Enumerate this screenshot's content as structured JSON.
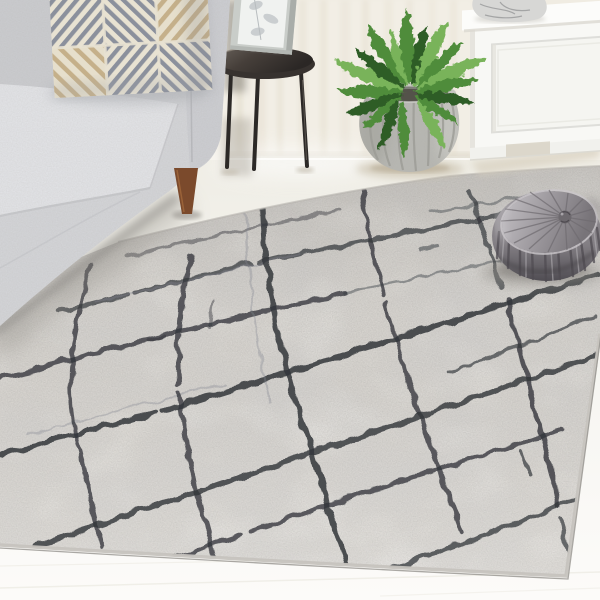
{
  "scene": {
    "kind": "product-photograph",
    "subject": "abstract-lattice-area-rug",
    "setting": "living-room",
    "objects": [
      "gray-sofa",
      "geometric-throw-pillow",
      "round-metal-side-table",
      "framed-botanical-print",
      "sheer-curtain",
      "boston-fern",
      "ribbed-stone-planter",
      "white-storage-cabinet",
      "marble-decor-piece",
      "gray-velvet-pouf",
      "whitewashed-wood-floor",
      "gray-abstract-rug-with-charcoal-lattice-lines"
    ]
  },
  "palette": {
    "wall_curtain": "#f2eee5",
    "curtain_fold": "#e4ded0",
    "baseboard": "#fbfaf6",
    "floor": "#f1efe8",
    "floor_bright": "#fcfbf8",
    "rug_base": "#d9d6d1",
    "rug_mottle_dark": "#b2b0ad",
    "rug_mottle_light": "#ece9e4",
    "rug_line_dark": "#33363b",
    "rug_line_soft": "#84888e",
    "rug_binding": "#c6c3be",
    "sofa_body": "#d2d3d6",
    "sofa_seat": "#e0e1e4",
    "sofa_arm": "#cbccd0",
    "sofa_leg_wood": "#7b4a2c",
    "pillow_cream": "#e8e2d2",
    "pillow_gray": "#8b909c",
    "pillow_tan": "#c5b08a",
    "table_metal": "#37322f",
    "frame": "#c9cdc9",
    "frame_art": "#f0f2f0",
    "fern_dark": "#2f5d27",
    "fern_mid": "#4f8c3b",
    "fern_light": "#79b35a",
    "pot_stone": "#b7b7b2",
    "pot_rib": "#9c9c96",
    "pot_inner": "#7e7e78",
    "cabinet_white": "#f8f8f5",
    "cabinet_shadow": "#d8d0c0",
    "marble": "#d7d7d5",
    "marble_vein": "#8f9092",
    "pouf_light": "#c3c0c4",
    "pouf_mid": "#8e8a8f",
    "pouf_dark": "#57545a"
  }
}
